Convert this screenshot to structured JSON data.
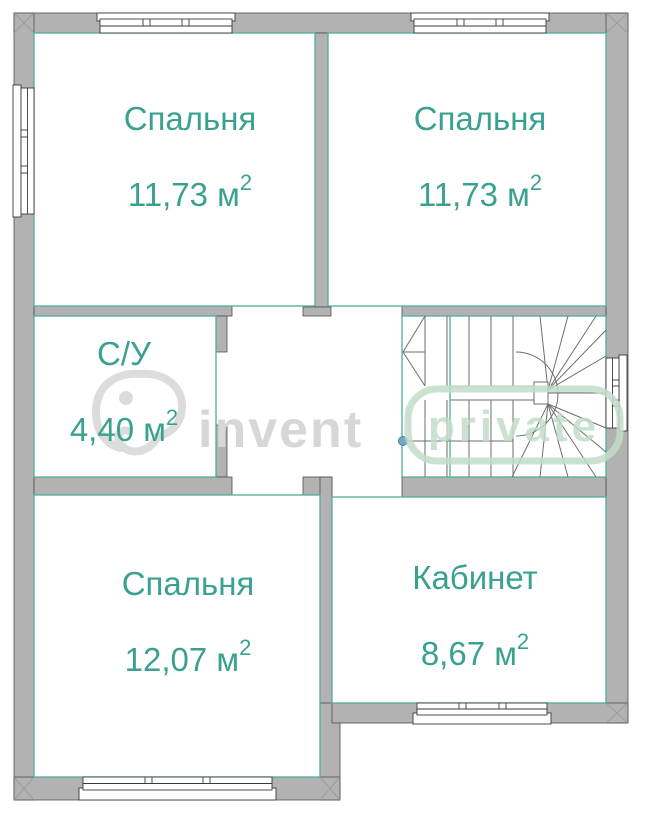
{
  "plan_title": "Floor plan",
  "rooms": [
    {
      "id": "bedroom-top-left",
      "name": "Спальня",
      "area": "11,73 м",
      "sup": "2"
    },
    {
      "id": "bedroom-top-right",
      "name": "Спальня",
      "area": "11,73 м",
      "sup": "2"
    },
    {
      "id": "bathroom",
      "name": "С/У",
      "area": "4,40 м",
      "sup": "2"
    },
    {
      "id": "bedroom-bottom",
      "name": "Спальня",
      "area": "12,07 м",
      "sup": "2"
    },
    {
      "id": "office",
      "name": "Кабинет",
      "area": "8,67 м",
      "sup": "2"
    }
  ],
  "watermark": {
    "brand": "invent",
    "badge": "private"
  },
  "colors": {
    "wall_fill": "#b2b2b2",
    "wall_stroke": "#4e4e4e",
    "room_border": "#4fae9f",
    "label_text": "#3aa191",
    "stair_lines": "#6e6e6e",
    "watermark_gray": "#d7d7d7",
    "watermark_green": "#c2ddc9",
    "stair_dot": "#73a8c3"
  }
}
